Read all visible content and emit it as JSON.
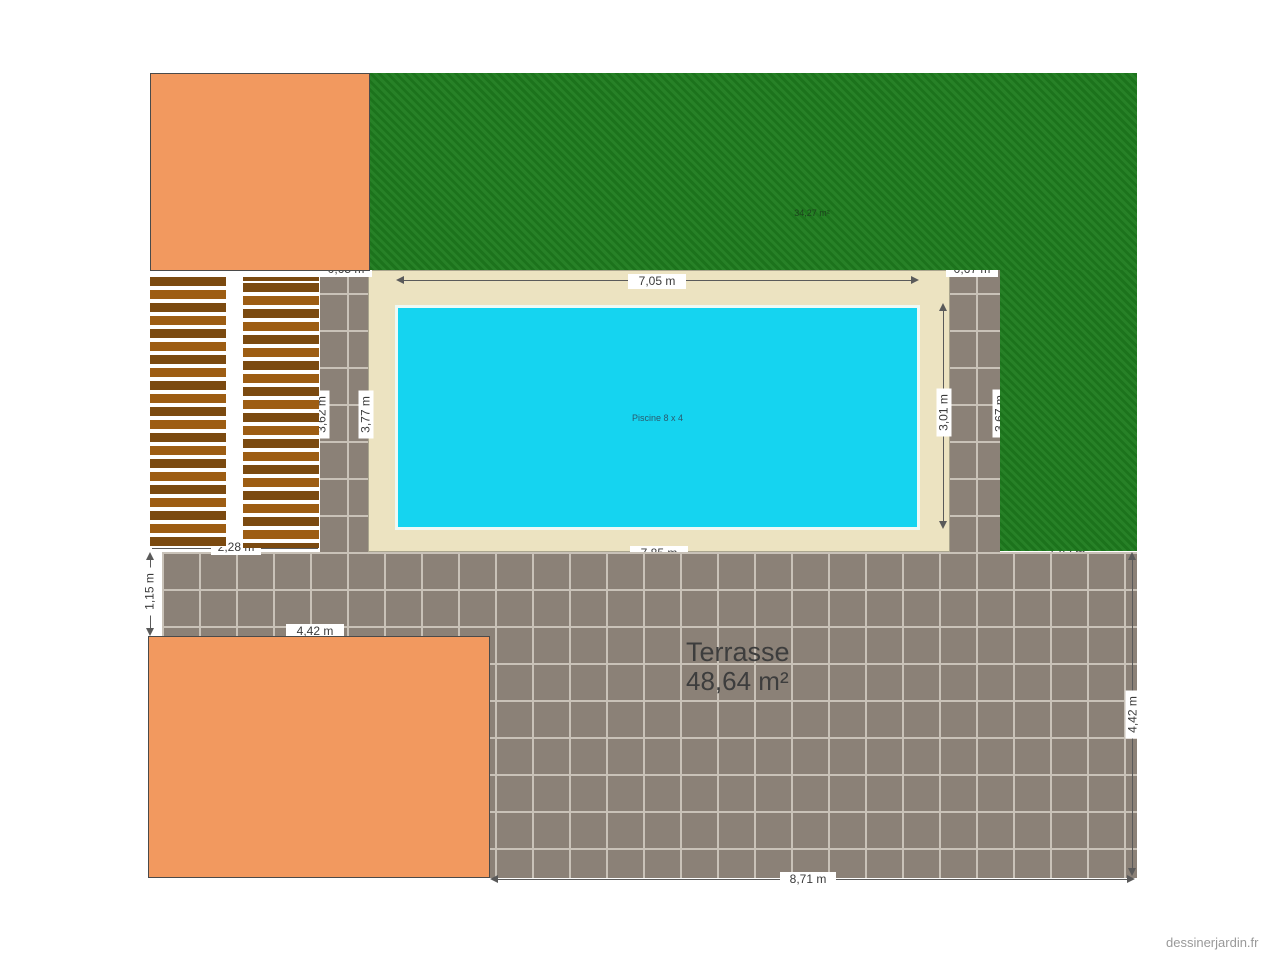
{
  "watermark": "dessinerjardin.fr",
  "regions": {
    "lawn": {
      "area_label": "34,27 m²"
    },
    "pool": {
      "label": "Piscine 8 x 4"
    },
    "terrace": {
      "name": "Terrasse",
      "area": "48,64 m²"
    }
  },
  "dimensions": {
    "pool_width": "7,05 m",
    "pool_height": "3,01 m",
    "left_strip_height": "3,77 m",
    "deck_height": "3,62 m",
    "right_lawn_height": "3,67 m",
    "deck_width": "2,28 m",
    "terrace_upper_height": "1,15 m",
    "terrace_left_width": "4,42 m",
    "terrace_right_height": "4,42 m",
    "terrace_bottom_width": "8,71 m",
    "top_left_offset": "0,65 m",
    "top_right_offset": "0,67 m",
    "surround_bottom_width": "7,85 m",
    "lawn_bottom_width": "1,82 m"
  },
  "colors": {
    "lawn": "#1e7c1e",
    "pool_water": "#15d4f0",
    "pool_surround": "#ece3c1",
    "terrace_tile": "#8b8177",
    "building": "#f2995f",
    "deck_dark": "#7b4a10",
    "deck_light": "#9d5d13"
  }
}
